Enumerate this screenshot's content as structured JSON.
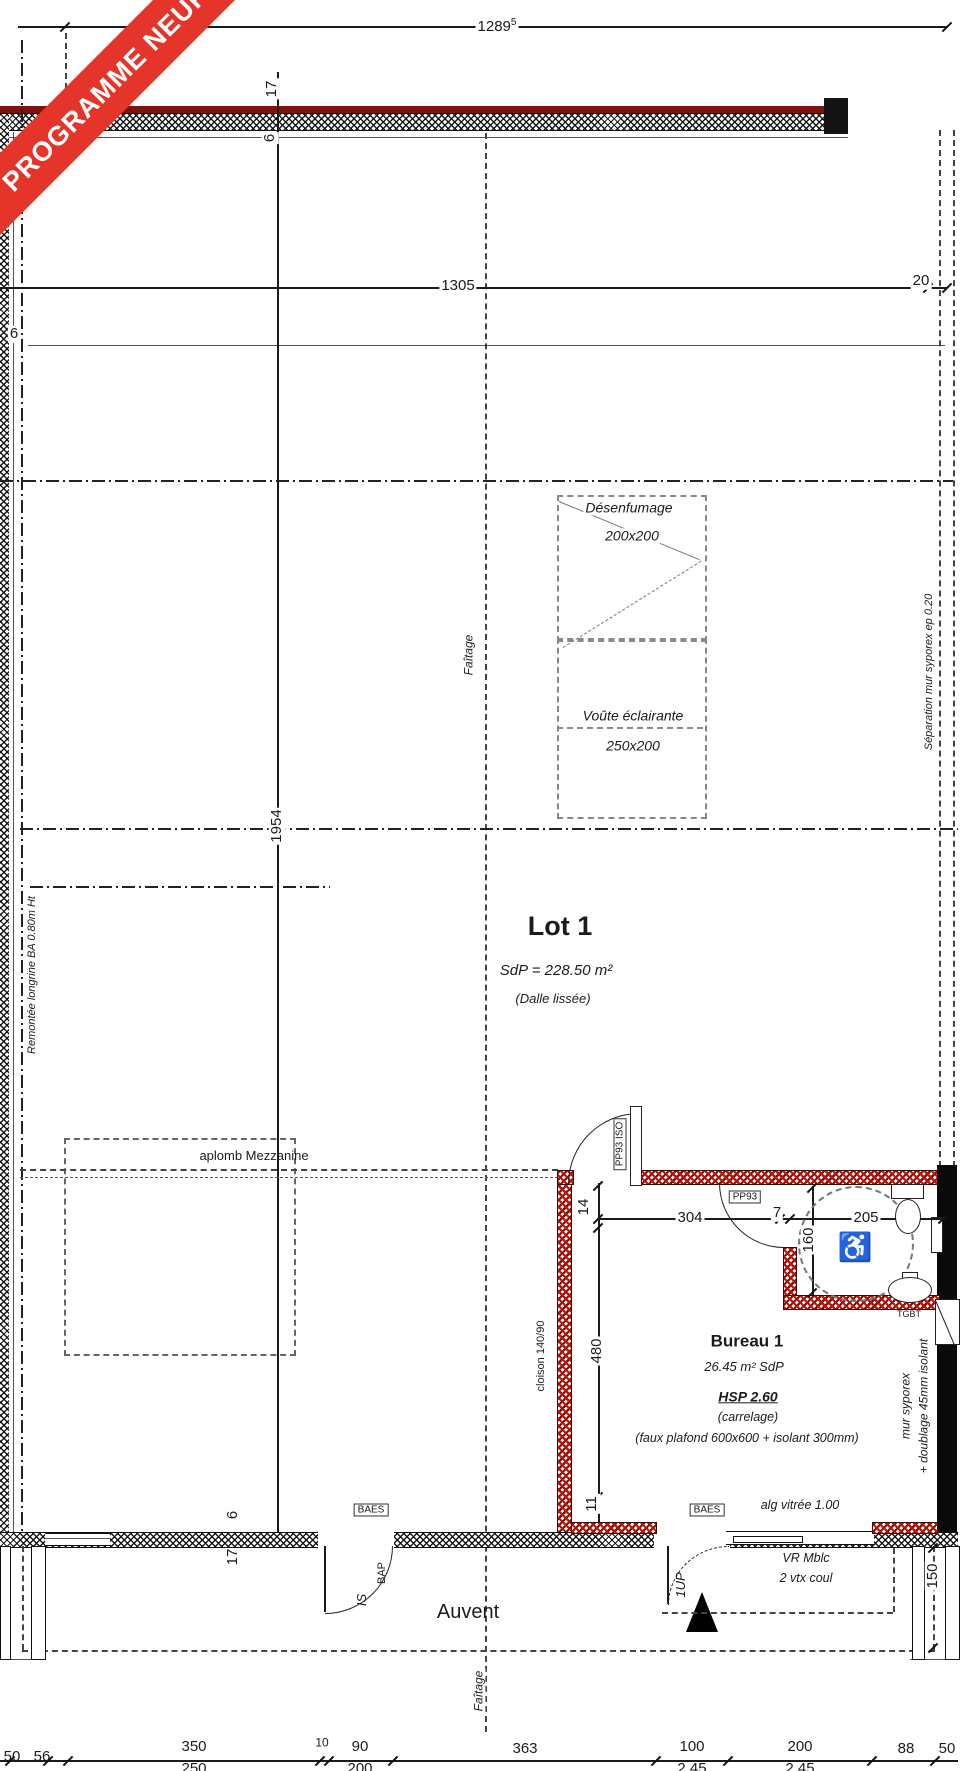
{
  "banner": {
    "text": "PROGRAMME NEUF",
    "color": "#e5352b"
  },
  "dims": {
    "top_width": "1289",
    "top_width_sup": "5",
    "d1305": "1305",
    "d20": "20",
    "d6_left": "6",
    "wall_top_17": "17",
    "wall_top_6": "6",
    "d1954": "1954",
    "d14": "14",
    "d304": "304",
    "d7": "7",
    "d205": "205",
    "d160": "160",
    "d480": "480",
    "d11": "11",
    "wall_bot_6": "6",
    "wall_bot_17": "17",
    "d150": "150",
    "bottom_row1": [
      "50",
      "56",
      "350",
      "10",
      "90",
      "363",
      "100",
      "200",
      "88",
      "50"
    ],
    "bottom_row2": [
      "250",
      "200",
      "2.45",
      "2.45"
    ]
  },
  "labels": {
    "desenfumage": "Désenfumage",
    "desenfumage_size": "200x200",
    "voute": "Voûte éclairante",
    "voute_size": "250x200",
    "faitage": "Faîtage",
    "separation": "Séparation mur syporex ep 0.20",
    "remontee": "Remontée longrine BA 0.80m Ht",
    "aplomb": "aplomb Mezzanine",
    "cloison": "cloison 140/90",
    "mur_syporex": "mur syporex",
    "doublage": "+ doublage 45mm isolant",
    "tgbt": "TGBT",
    "auvent": "Auvent",
    "alg_vitree": "alg vitrée 1.00",
    "vr_line1": "VR Mblc",
    "vr_line2": "2 vtx coul",
    "bap": "BAP",
    "is": "IS",
    "up": "1UP",
    "baes": "BAES",
    "pp93_iso": "PP93 ISO",
    "pp93": "PP93",
    "wheelchair_icon": "♿"
  },
  "rooms": {
    "lot1": {
      "name": "Lot 1",
      "area": "SdP = 228.50 m²",
      "floor": "(Dalle lissée)"
    },
    "bureau1": {
      "name": "Bureau 1",
      "area": "26.45 m² SdP",
      "hsp": "HSP 2.60",
      "floor": "(carrelage)",
      "ceiling": "(faux plafond 600x600 + isolant 300mm)"
    }
  }
}
